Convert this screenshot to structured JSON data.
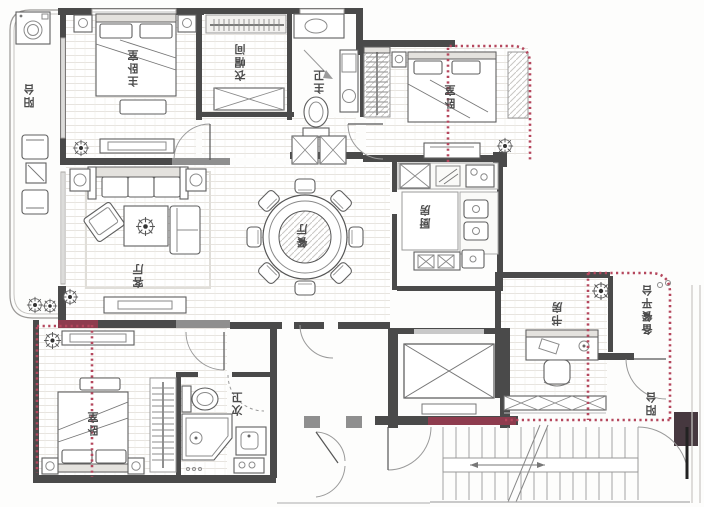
{
  "plan": {
    "rooms": {
      "balcony_left": {
        "label": "阳台"
      },
      "master_bedroom": {
        "label": "主卧室"
      },
      "cloakroom": {
        "label": "衣帽间"
      },
      "master_bath": {
        "label": "主卫"
      },
      "bedroom_right": {
        "label": "卧室"
      },
      "living_room": {
        "label": "客厅"
      },
      "dining_room": {
        "label": "餐厅"
      },
      "kitchen": {
        "label": "厨房"
      },
      "study": {
        "label": "书房"
      },
      "prep_platform": {
        "label": "备餐平台"
      },
      "balcony_right": {
        "label": "阳台"
      },
      "bedroom_bottom": {
        "label": "卧室"
      },
      "second_bath": {
        "label": "次卫"
      }
    },
    "colors": {
      "wall": "#4a4a4a",
      "accent_red_dotted": "#b5475d",
      "modified_wall_maroon": "#8e3c4e"
    }
  }
}
